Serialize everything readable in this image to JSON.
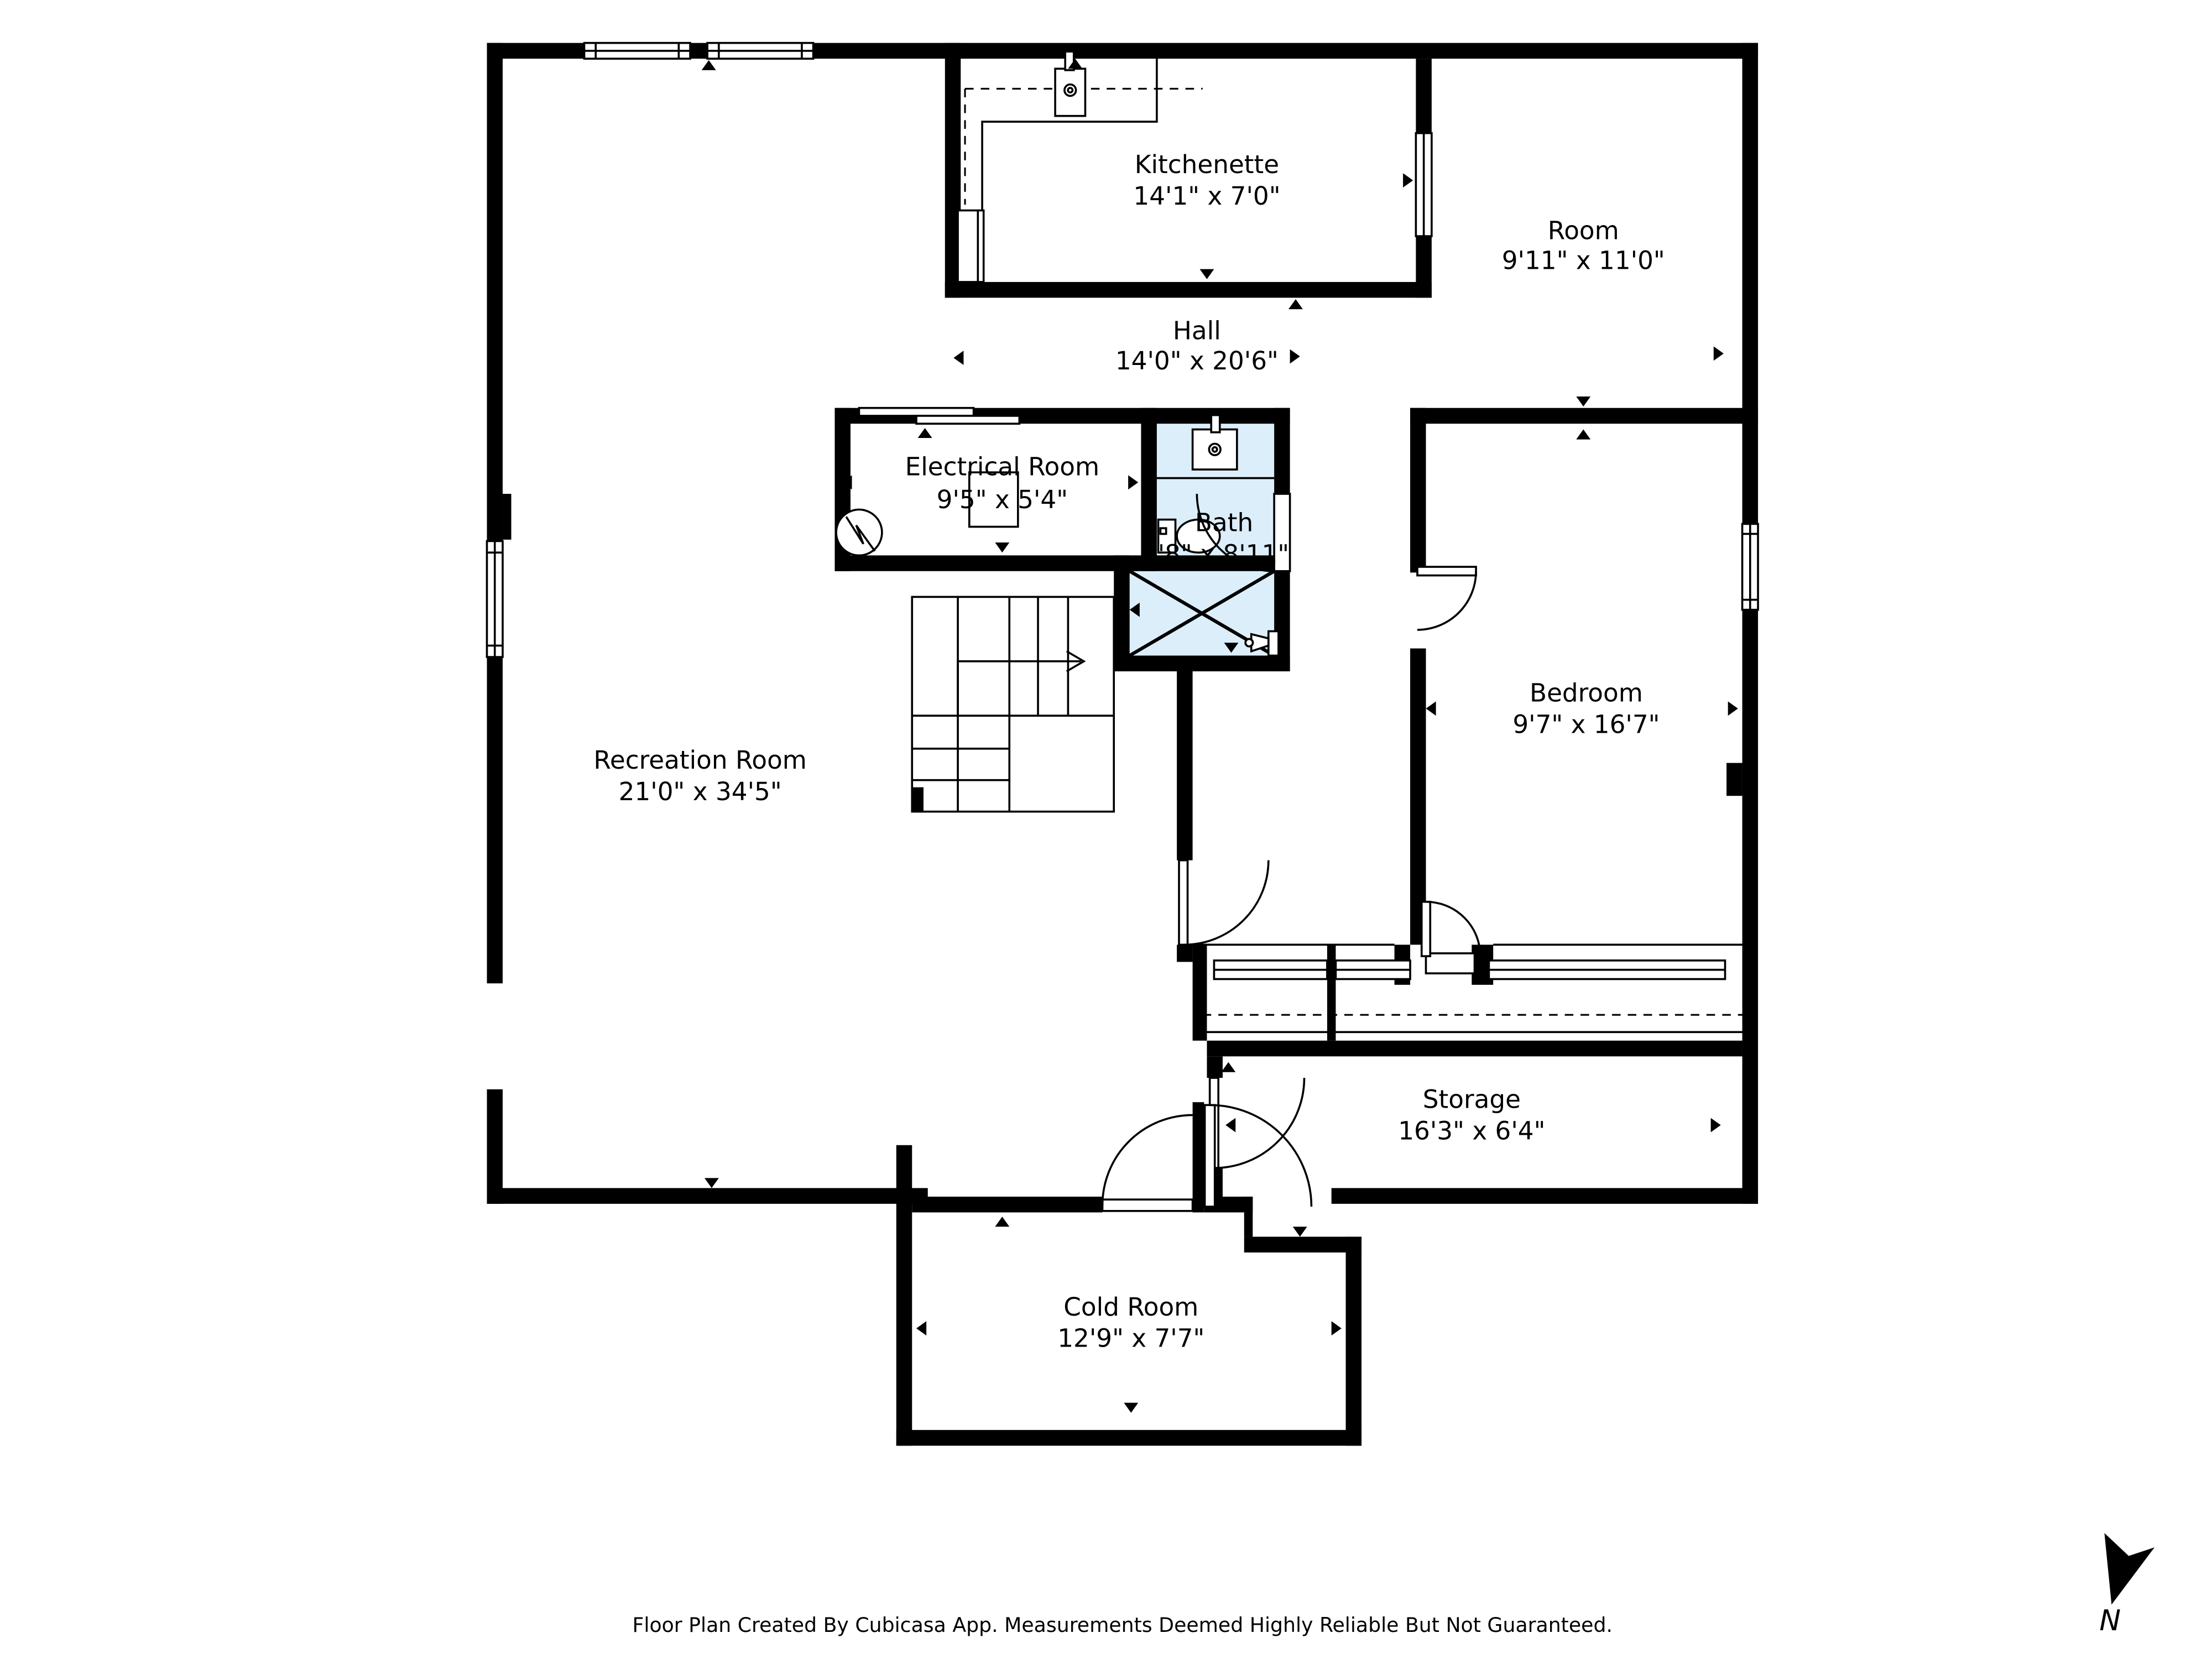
{
  "rooms": [
    {
      "name": "Kitchenette",
      "dims": "14'1\" x 7'0\""
    },
    {
      "name": "Room",
      "dims": "9'11\" x 11'0\""
    },
    {
      "name": "Hall",
      "dims": "14'0\" x 20'6\""
    },
    {
      "name": "Electrical Room",
      "dims": "9'5\" x 5'4\""
    },
    {
      "name": "Bath",
      "dims": "4'8\" x 8'11\""
    },
    {
      "name": "Bedroom",
      "dims": "9'7\" x 16'7\""
    },
    {
      "name": "Recreation Room",
      "dims": "21'0\" x 34'5\""
    },
    {
      "name": "Storage",
      "dims": "16'3\" x 6'4\""
    },
    {
      "name": "Cold Room",
      "dims": "12'9\" x 7'7\""
    }
  ],
  "footer": {
    "text": "Floor Plan Created By Cubicasa App. Measurements Deemed Highly Reliable But Not Guaranteed."
  },
  "north": {
    "label": "N"
  },
  "colors": {
    "wall": "#000000",
    "wet_area_fill": "#dceef9",
    "background": "#ffffff"
  }
}
